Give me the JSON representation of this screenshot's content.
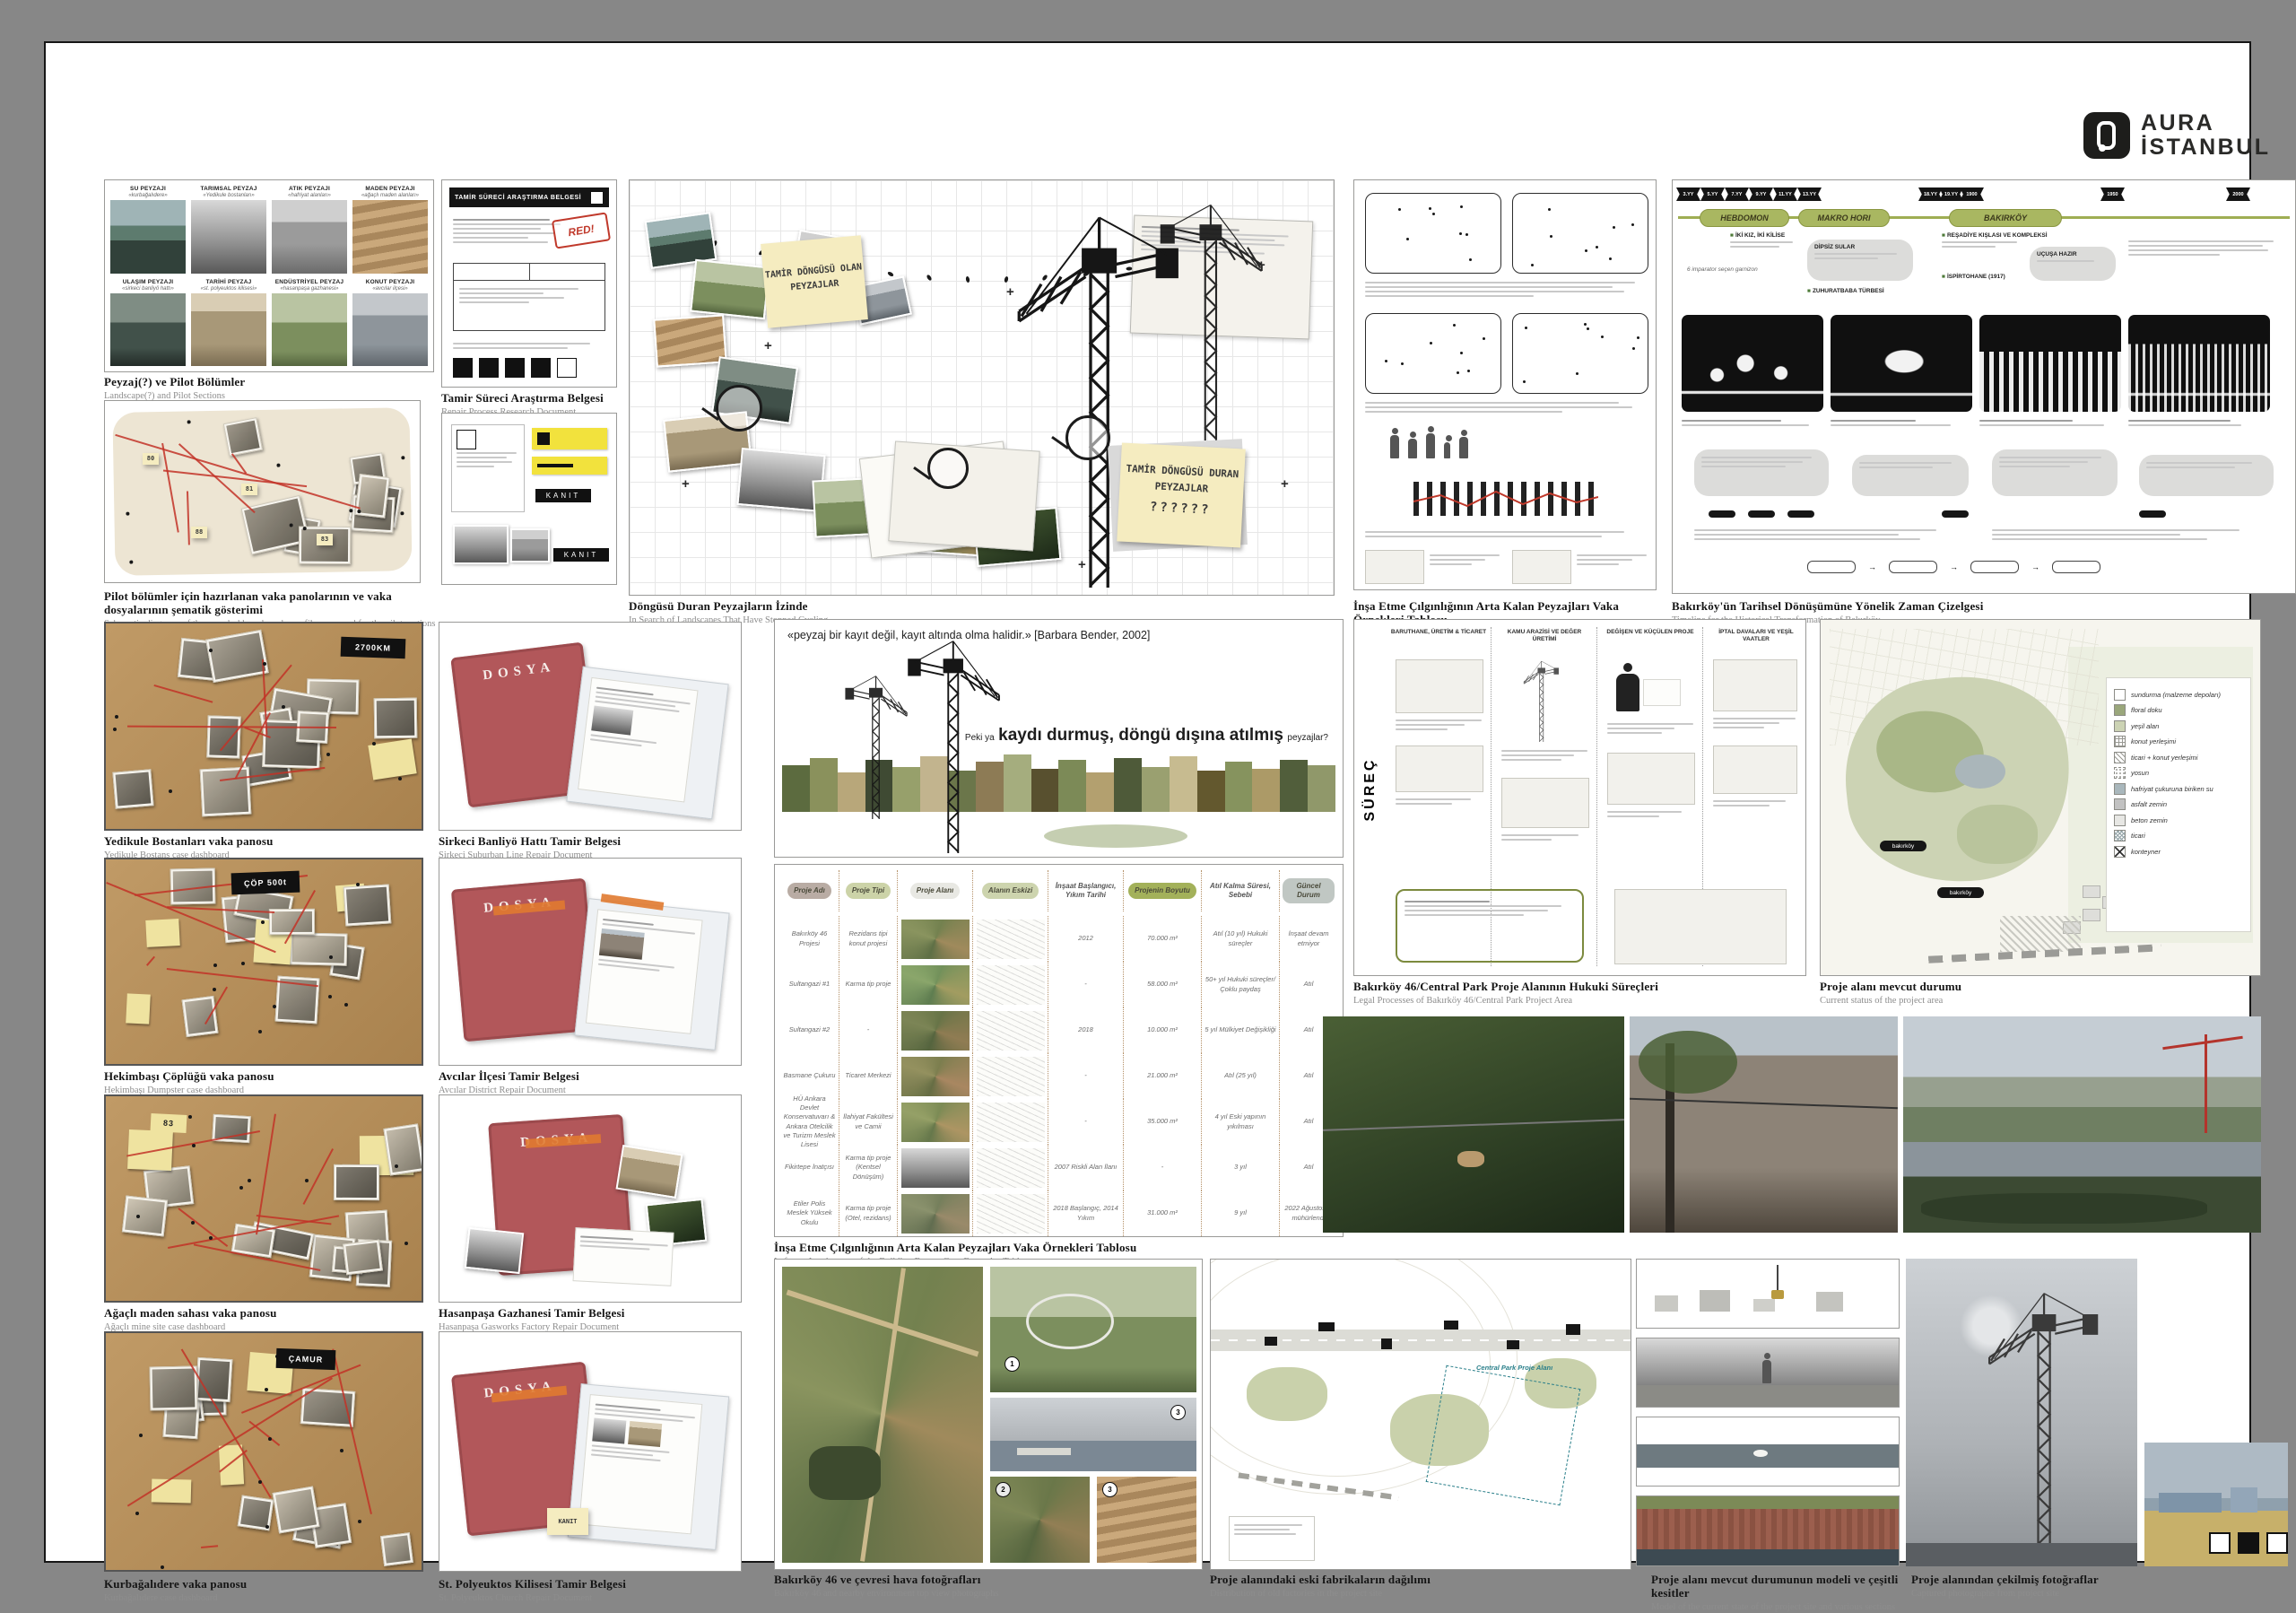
{
  "logo": {
    "top": "AURA",
    "bottom": "İSTANBUL"
  },
  "pilot": {
    "cells": [
      {
        "t": "SU PEYZAJI",
        "s": "«kurbağalıdere»"
      },
      {
        "t": "TARIMSAL PEYZAJ",
        "s": "«Yedikule bostanları»"
      },
      {
        "t": "ATIK PEYZAJI",
        "s": "«hafriyat alanları»"
      },
      {
        "t": "MADEN PEYZAJI",
        "s": "«ağaçlı maden alanları»"
      },
      {
        "t": "ULAŞIM PEYZAJI",
        "s": "«sirkeci banliyö hattı»"
      },
      {
        "t": "TARİHİ PEYZAJ",
        "s": "«st. polyeuktos kilisesi»"
      },
      {
        "t": "ENDÜSTRİYEL PEYZAJ",
        "s": "«hasanpaşa gazhanesi»"
      },
      {
        "t": "KONUT PEYZAJI",
        "s": "«avcılar ilçesi»"
      }
    ],
    "cap_tr": "Peyzaj(?) ve Pilot Bölümler",
    "cap_en": "Landscape(?) and Pilot Sections"
  },
  "schematic": {
    "notes": [
      "80",
      "81",
      "88",
      "83"
    ],
    "cap_tr": "Pilot bölümler için hazırlanan vaka panolarının ve vaka dosyalarının şematik gösterimi",
    "cap_en": "Schematic diagrams of the case dashboards and case files prepared for the pilot sections"
  },
  "repair": {
    "header": "TAMİR SÜRECİ ARAŞTIRMA BELGESİ",
    "stamp": "RED!",
    "cap_tr": "Tamir Süreci Araştırma Belgesi",
    "cap_en": "Repair Process Research Document"
  },
  "evidence": {
    "kanit": "KANIT"
  },
  "collage": {
    "note1": "TAMİR DÖNGÜSÜ OLAN PEYZAJLAR",
    "note2": "TAMİR DÖNGÜSÜ DURAN PEYZAJLAR",
    "note2_marks": "??????",
    "cap_tr": "Döngüsü Duran Peyzajların İzinde",
    "cap_en": "In Search of Landscapes That Have Stopped Cycling"
  },
  "methodology": {
    "cap_tr": "İnşa Etme Çılgınlığının Arta Kalan Peyzajları Vaka Örnekleri Tablosu",
    "cap_en": "Leftover Landscapes of the Building Frenzy Case Examples Table"
  },
  "timeline": {
    "ticks": [
      "3.YY",
      "5.YY",
      "7.YY",
      "9.YY",
      "11.YY",
      "13.YY",
      "18.YY",
      "19.YY",
      "1900",
      "1950",
      "2000"
    ],
    "eras": [
      "HEBDOMON",
      "MAKRO HORI",
      "BAKIRKÖY"
    ],
    "entries": [
      "İKİ KIZ, İKİ KİLİSE",
      "6 imparator seçen garnizon",
      "DİPSİZ SULAR",
      "REŞADİYE KIŞLASI VE KOMPLEKSİ",
      "UÇUŞA HAZIR",
      "İSPİRTOHANE (1917)",
      "ZUHURATBABA TÜRBESİ"
    ],
    "cap_tr": "Bakırköy'ün Tarihsel Dönüşümüne Yönelik Zaman Çizelgesi",
    "cap_en": "Timeline for the Historical Transformation of Bakırköy"
  },
  "boards": [
    {
      "tag": "2700KM",
      "cap_tr": "Yedikule Bostanları vaka panosu",
      "cap_en": "Yedikule Bostans case dashboard"
    },
    {
      "tag": "ÇÖP 500t",
      "cap_tr": "Hekimbaşı Çöplüğü vaka panosu",
      "cap_en": "Hekimbaşı Dumpster case dashboard"
    },
    {
      "tag": "83",
      "cap_tr": "Ağaçlı maden sahası vaka panosu",
      "cap_en": "Ağaçlı mine site case dashboard"
    },
    {
      "tag": "ÇAMUR",
      "cap_tr": "Kurbağalıdere vaka panosu",
      "cap_en": "Kurbağalıdere case dashboard"
    }
  ],
  "folders": {
    "label": "DOSYA",
    "items": [
      {
        "cap_tr": "Sirkeci Banliyö Hattı Tamir Belgesi",
        "cap_en": "Sirkeci Suburban Line Repair Document"
      },
      {
        "cap_tr": "Avcılar İlçesi Tamir Belgesi",
        "cap_en": "Avcılar District Repair Document"
      },
      {
        "cap_tr": "Hasanpaşa Gazhanesi Tamir Belgesi",
        "cap_en": "Hasanpaşa Gasworks Factory Repair Document"
      },
      {
        "cap_tr": "St. Polyeuktos Kilisesi Tamir Belgesi",
        "cap_en": "St. Polyeuktos Church Repair Document"
      }
    ]
  },
  "quote": {
    "text": "«peyzaj bir kayıt değil, kayıt altında olma halidir.» [Barbara Bender, 2002]",
    "prefix": "Peki ya",
    "bold": "kaydı durmuş, döngü dışına atılmış",
    "suffix": "peyzajlar?"
  },
  "table": {
    "headers": [
      "Proje Adı",
      "Proje Tipi",
      "Proje Alanı",
      "Alanın Eskizi",
      "İnşaat Başlangıcı, Yıkım Tarihi",
      "Projenin Boyutu",
      "Atıl Kalma Süresi, Sebebi",
      "Güncel Durum"
    ],
    "rows": [
      {
        "name": "Bakırköy 46 Projesi",
        "type": "Rezidans tipi konut projesi",
        "start": "2012",
        "size": "70.000 m²",
        "idle": "Atıl (10 yıl) Hukuki süreçler",
        "status": "İnşaat devam etmiyor"
      },
      {
        "name": "Sultangazi #1",
        "type": "Karma tip proje",
        "start": "-",
        "size": "58.000 m²",
        "idle": "50+ yıl Hukuki süreçler/ Çoklu paydaş",
        "status": "Atıl"
      },
      {
        "name": "Sultangazi #2",
        "type": "-",
        "start": "2018",
        "size": "10.000 m²",
        "idle": "5 yıl Mülkiyet Değişikliği",
        "status": "Atıl"
      },
      {
        "name": "Basmane Çukuru",
        "type": "Ticaret Merkezi",
        "start": "-",
        "size": "21.000 m²",
        "idle": "Atıl (25 yıl)",
        "status": "Atıl"
      },
      {
        "name": "HÜ Ankara Devlet Konservatuvarı & Ankara Otelcilik ve Turizm Meslek Lisesi",
        "type": "İlahiyat Fakültesi ve Camii",
        "start": "-",
        "size": "35.000 m²",
        "idle": "4 yıl Eski yapının yıkılması",
        "status": "Atıl"
      },
      {
        "name": "Fikirtepe İnatçısı",
        "type": "Karma tip proje (Kentsel Dönüşüm)",
        "start": "2007 Riskli Alan İlanı",
        "size": "-",
        "idle": "3 yıl",
        "status": "Atıl"
      },
      {
        "name": "Etiler Polis Meslek Yüksek Okulu",
        "type": "Karma tip proje (Otel, rezidans)",
        "start": "2018 Başlangıç, 2014 Yıkım",
        "size": "31.000 m²",
        "idle": "9 yıl",
        "status": "2022 Ağustos'ta mühürlendi"
      }
    ],
    "cap_tr": "İnşa Etme Çılgınlığının Arta Kalan Peyzajları Vaka Örnekleri Tablosu",
    "cap_en": "Leftover Landscapes of the Building Frenzy Case Examples Table"
  },
  "process": {
    "title": "SÜREÇ",
    "columns": [
      "BARUTHANE, ÜRETİM & TİCARET",
      "KAMU ARAZİSİ VE DEĞER ÜRETİMİ",
      "DEĞİŞEN VE KÜÇÜLEN PROJE",
      "İPTAL DAVALARI VE YEŞİL VAATLER"
    ],
    "cap_tr": "Bakırköy 46/Central Park Proje Alanının Hukuki Süreçleri",
    "cap_en": "Legal Processes of Bakırköy 46/Central Park Project Area"
  },
  "map": {
    "pill": "bakırköy",
    "legend": [
      {
        "label": "sundurma (malzeme depoları)",
        "swatch": "white"
      },
      {
        "label": "floral doku",
        "swatch": "floral"
      },
      {
        "label": "yeşil alan",
        "swatch": "green"
      },
      {
        "label": "konut yerleşimi",
        "swatch": "grid"
      },
      {
        "label": "ticari + konut yerleşimi",
        "swatch": "diag"
      },
      {
        "label": "yosun",
        "swatch": "dots"
      },
      {
        "label": "hafriyat çukuruna biriken su",
        "swatch": "water"
      },
      {
        "label": "asfalt zemin",
        "swatch": "asphalt"
      },
      {
        "label": "beton zemin",
        "swatch": "concrete"
      },
      {
        "label": "ticari",
        "swatch": "comm"
      },
      {
        "label": "konteyner",
        "swatch": "cont"
      }
    ],
    "cap_tr": "Proje alanı mevcut durumu",
    "cap_en": "Current status of the project area"
  },
  "aerial": {
    "markers": [
      "1",
      "2",
      "3"
    ],
    "cap_tr": "Bakırköy 46 ve çevresi hava fotoğrafları",
    "cap_en": "Bakırköy 46 and nearby environment top view photographs"
  },
  "factories": {
    "label": "Central Park Proje Alanı",
    "cap_tr": "Proje alanındaki eski fabrikaların dağılımı",
    "cap_en": "Distribution of old factories in the project site"
  },
  "model": {
    "cap_tr": "Proje alanı mevcut durumunun modeli ve çeşitli kesitler",
    "cap_en": "Model of the current state of the project site and various sections"
  },
  "sitephotos": {
    "cap_tr": "Proje alanından çekilmiş fotoğraflar",
    "cap_en": "Captured photographs from project site"
  }
}
